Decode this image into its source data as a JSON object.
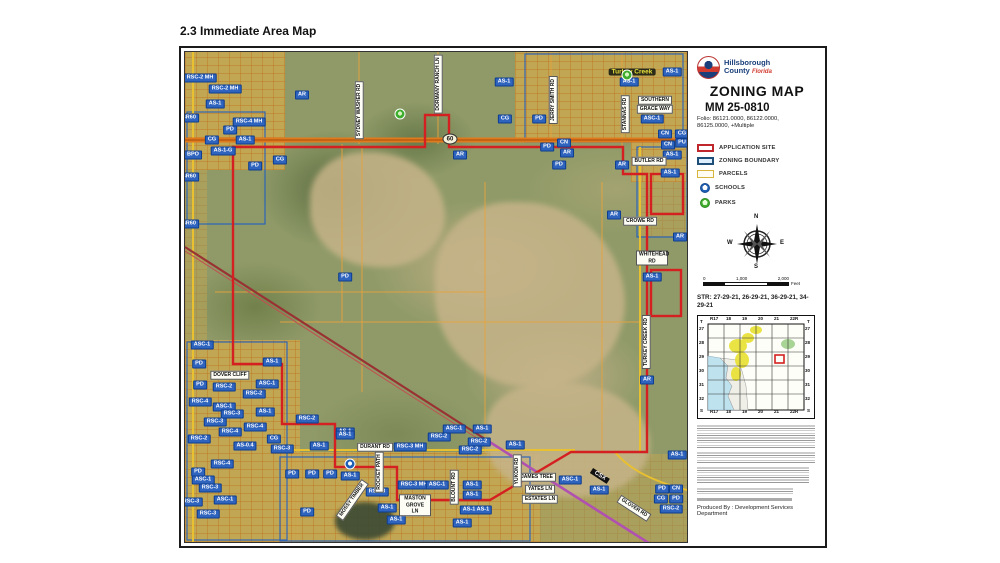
{
  "page": {
    "title": "2.3 Immediate Area Map"
  },
  "sidebar": {
    "logo": {
      "org_line1": "Hillsborough",
      "org_line2": "County",
      "state": "Florida"
    },
    "map_title": "ZONING MAP",
    "case_number": "MM 25-0810",
    "folio": "Folio: 86121.0000, 86122.0000, 86125.0000, +Multiple",
    "legend": {
      "items": [
        {
          "label": "APPLICATION SITE",
          "swatch": "app",
          "color": "#c0272d"
        },
        {
          "label": "ZONING BOUNDARY",
          "swatch": "zb",
          "color": "#1f4e79"
        },
        {
          "label": "PARCELS",
          "swatch": "par",
          "color": "#d8b53c"
        },
        {
          "label": "SCHOOLS",
          "swatch": "sch",
          "color": "#1f5fb5"
        },
        {
          "label": "PARKS",
          "swatch": "prk",
          "color": "#3fae2f"
        }
      ]
    },
    "compass": {
      "n": "N",
      "e": "E",
      "s": "S",
      "w": "W"
    },
    "scale": {
      "ticks": [
        "0",
        "1,000",
        "2,000"
      ],
      "unit": "Feet"
    },
    "str": "STR: 27-29-21, 26-29-21, 36-29-21, 34-29-21",
    "locator": {
      "cols": [
        "R17",
        "18",
        "19",
        "20",
        "21",
        "22R"
      ],
      "rows": [
        "27",
        "28",
        "29",
        "30",
        "31",
        "32"
      ],
      "corner_top": "T",
      "corner_bottom": "S",
      "highlight_cell": {
        "col": "21",
        "row": "29"
      }
    },
    "produced_by": "Produced By : Development Services Department"
  },
  "map": {
    "shield_60": "60",
    "labels": [
      {
        "x": 15,
        "y": 26,
        "t": "RSC-2 MH",
        "k": "z"
      },
      {
        "x": 40,
        "y": 37,
        "t": "RSC-2 MH",
        "k": "z"
      },
      {
        "x": 30,
        "y": 52,
        "t": "AS-1",
        "k": "z"
      },
      {
        "x": 64,
        "y": 70,
        "t": "RSC-4 MH",
        "k": "z"
      },
      {
        "x": 45,
        "y": 78,
        "t": "PD",
        "k": "z"
      },
      {
        "x": 27,
        "y": 88,
        "t": "CG",
        "k": "z"
      },
      {
        "x": 60,
        "y": 88,
        "t": "AS-1",
        "k": "z"
      },
      {
        "x": 38,
        "y": 99,
        "t": "AS-1-G",
        "k": "z"
      },
      {
        "x": 8,
        "y": 103,
        "t": "BPO",
        "k": "z"
      },
      {
        "x": 70,
        "y": 114,
        "t": "PD",
        "k": "z"
      },
      {
        "x": 95,
        "y": 108,
        "t": "CG",
        "k": "z"
      },
      {
        "x": 117,
        "y": 43,
        "t": "AR",
        "k": "z"
      },
      {
        "x": 4,
        "y": 66,
        "t": "SR60",
        "k": "z"
      },
      {
        "x": 4,
        "y": 125,
        "t": "SR60",
        "k": "z"
      },
      {
        "x": 4,
        "y": 172,
        "t": "SR60",
        "k": "z"
      },
      {
        "x": 319,
        "y": 30,
        "t": "AS-1",
        "k": "z"
      },
      {
        "x": 320,
        "y": 67,
        "t": "CG",
        "k": "z"
      },
      {
        "x": 354,
        "y": 67,
        "t": "PD",
        "k": "z"
      },
      {
        "x": 487,
        "y": 20,
        "t": "AS-1",
        "k": "z"
      },
      {
        "x": 444,
        "y": 30,
        "t": "AS-1",
        "k": "z"
      },
      {
        "x": 467,
        "y": 67,
        "t": "ASC-1",
        "k": "z"
      },
      {
        "x": 480,
        "y": 82,
        "t": "CN",
        "k": "z"
      },
      {
        "x": 497,
        "y": 82,
        "t": "CG",
        "k": "z"
      },
      {
        "x": 483,
        "y": 93,
        "t": "CN",
        "k": "z"
      },
      {
        "x": 497,
        "y": 91,
        "t": "PU",
        "k": "z"
      },
      {
        "x": 487,
        "y": 103,
        "t": "AS-1",
        "k": "z"
      },
      {
        "x": 437,
        "y": 113,
        "t": "AR",
        "k": "z"
      },
      {
        "x": 485,
        "y": 121,
        "t": "AS-1",
        "k": "z"
      },
      {
        "x": 362,
        "y": 95,
        "t": "PD",
        "k": "z"
      },
      {
        "x": 379,
        "y": 91,
        "t": "CN",
        "k": "z"
      },
      {
        "x": 382,
        "y": 101,
        "t": "AR",
        "k": "z"
      },
      {
        "x": 374,
        "y": 113,
        "t": "PD",
        "k": "z"
      },
      {
        "x": 275,
        "y": 103,
        "t": "AR",
        "k": "z"
      },
      {
        "x": 429,
        "y": 163,
        "t": "AR",
        "k": "z"
      },
      {
        "x": 495,
        "y": 185,
        "t": "AR",
        "k": "z"
      },
      {
        "x": 467,
        "y": 225,
        "t": "AS-1",
        "k": "z"
      },
      {
        "x": 462,
        "y": 328,
        "t": "AR",
        "k": "z"
      },
      {
        "x": 160,
        "y": 225,
        "t": "PD",
        "k": "z"
      },
      {
        "x": 17,
        "y": 293,
        "t": "ASC-1",
        "k": "z"
      },
      {
        "x": 14,
        "y": 312,
        "t": "PD",
        "k": "z"
      },
      {
        "x": 15,
        "y": 333,
        "t": "PD",
        "k": "z"
      },
      {
        "x": 39,
        "y": 335,
        "t": "RSC-2",
        "k": "z"
      },
      {
        "x": 87,
        "y": 310,
        "t": "AS-1",
        "k": "z"
      },
      {
        "x": 82,
        "y": 332,
        "t": "ASC-1",
        "k": "z"
      },
      {
        "x": 69,
        "y": 342,
        "t": "RSC-2",
        "k": "z"
      },
      {
        "x": 15,
        "y": 350,
        "t": "RSC-4",
        "k": "z"
      },
      {
        "x": 39,
        "y": 355,
        "t": "ASC-1",
        "k": "z"
      },
      {
        "x": 47,
        "y": 362,
        "t": "RSC-3",
        "k": "z"
      },
      {
        "x": 80,
        "y": 360,
        "t": "AS-1",
        "k": "z"
      },
      {
        "x": 30,
        "y": 370,
        "t": "RSC-3",
        "k": "z"
      },
      {
        "x": 70,
        "y": 375,
        "t": "RSC-4",
        "k": "z"
      },
      {
        "x": 45,
        "y": 380,
        "t": "RSC-4",
        "k": "z"
      },
      {
        "x": 14,
        "y": 387,
        "t": "RSC-2",
        "k": "z"
      },
      {
        "x": 89,
        "y": 387,
        "t": "CG",
        "k": "z"
      },
      {
        "x": 60,
        "y": 394,
        "t": "AS-0.4",
        "k": "z"
      },
      {
        "x": 97,
        "y": 397,
        "t": "RSC-3",
        "k": "z"
      },
      {
        "x": 122,
        "y": 367,
        "t": "RSC-2",
        "k": "z"
      },
      {
        "x": 160,
        "y": 380,
        "t": "AS-1",
        "k": "z"
      },
      {
        "x": 134,
        "y": 394,
        "t": "AS-1",
        "k": "z"
      },
      {
        "x": 225,
        "y": 395,
        "t": "RSC-3 MH",
        "k": "z"
      },
      {
        "x": 160,
        "y": 383,
        "t": "AS-1",
        "k": "z"
      },
      {
        "x": 269,
        "y": 377,
        "t": "ASC-1",
        "k": "z"
      },
      {
        "x": 297,
        "y": 377,
        "t": "AS-1",
        "k": "z"
      },
      {
        "x": 254,
        "y": 385,
        "t": "RSC-2",
        "k": "z"
      },
      {
        "x": 294,
        "y": 390,
        "t": "RSC-2",
        "k": "z"
      },
      {
        "x": 285,
        "y": 398,
        "t": "RSC-2",
        "k": "z"
      },
      {
        "x": 330,
        "y": 393,
        "t": "AS-1",
        "k": "z"
      },
      {
        "x": 165,
        "y": 424,
        "t": "AS-1",
        "k": "z"
      },
      {
        "x": 229,
        "y": 433,
        "t": "RSC-3 MH",
        "k": "z"
      },
      {
        "x": 252,
        "y": 433,
        "t": "ASC-1",
        "k": "z"
      },
      {
        "x": 287,
        "y": 433,
        "t": "AS-1",
        "k": "z"
      },
      {
        "x": 287,
        "y": 443,
        "t": "AS-1",
        "k": "z"
      },
      {
        "x": 192,
        "y": 440,
        "t": "RSC-3",
        "k": "z"
      },
      {
        "x": 202,
        "y": 456,
        "t": "AS-1",
        "k": "z"
      },
      {
        "x": 211,
        "y": 468,
        "t": "AS-1",
        "k": "z"
      },
      {
        "x": 291,
        "y": 458,
        "t": "AS-1 AS-1",
        "k": "z"
      },
      {
        "x": 277,
        "y": 471,
        "t": "AS-1",
        "k": "z"
      },
      {
        "x": 414,
        "y": 438,
        "t": "AS-1",
        "k": "z"
      },
      {
        "x": 477,
        "y": 437,
        "t": "PD",
        "k": "z"
      },
      {
        "x": 476,
        "y": 447,
        "t": "CG",
        "k": "z"
      },
      {
        "x": 491,
        "y": 437,
        "t": "CN",
        "k": "z"
      },
      {
        "x": 491,
        "y": 447,
        "t": "PD",
        "k": "z"
      },
      {
        "x": 486,
        "y": 457,
        "t": "RSC-2",
        "k": "z"
      },
      {
        "x": 492,
        "y": 403,
        "t": "AS-1",
        "k": "z"
      },
      {
        "x": 385,
        "y": 428,
        "t": "ASC-1",
        "k": "z"
      },
      {
        "x": 37,
        "y": 412,
        "t": "RSC-4",
        "k": "z"
      },
      {
        "x": 13,
        "y": 420,
        "t": "PD",
        "k": "z"
      },
      {
        "x": 18,
        "y": 428,
        "t": "ASC-1",
        "k": "z"
      },
      {
        "x": 25,
        "y": 436,
        "t": "RSC-3",
        "k": "z"
      },
      {
        "x": 6,
        "y": 450,
        "t": "RSC-3",
        "k": "z"
      },
      {
        "x": 40,
        "y": 448,
        "t": "ASC-1",
        "k": "z"
      },
      {
        "x": 23,
        "y": 462,
        "t": "RSC-3",
        "k": "z"
      },
      {
        "x": 107,
        "y": 422,
        "t": "PD",
        "k": "z"
      },
      {
        "x": 127,
        "y": 422,
        "t": "PD",
        "k": "z"
      },
      {
        "x": 145,
        "y": 422,
        "t": "PD",
        "k": "z"
      },
      {
        "x": 122,
        "y": 460,
        "t": "PD",
        "k": "z"
      },
      {
        "x": 470,
        "y": 48,
        "t": "SOUTHERN",
        "k": "r"
      },
      {
        "x": 470,
        "y": 57,
        "t": "GRACE WAY",
        "k": "r"
      },
      {
        "x": 464,
        "y": 109,
        "t": "BUTLER RD",
        "k": "r"
      },
      {
        "x": 455,
        "y": 169,
        "t": "CROWE RD",
        "k": "r"
      },
      {
        "x": 467,
        "y": 206,
        "t": "WHITEHEAD RD",
        "k": "r",
        "wrap": true
      },
      {
        "x": 45,
        "y": 323,
        "t": "DOVER CLIFF",
        "k": "r"
      },
      {
        "x": 190,
        "y": 395,
        "t": "DURANT RD",
        "k": "r"
      },
      {
        "x": 230,
        "y": 453,
        "t": "MASTON GROVE LN",
        "k": "r",
        "wrap": true
      },
      {
        "x": 352,
        "y": 425,
        "t": "JAMES TREE",
        "k": "r"
      },
      {
        "x": 355,
        "y": 437,
        "t": "YATES LN",
        "k": "r"
      },
      {
        "x": 355,
        "y": 447,
        "t": "ESTATES LN",
        "k": "r"
      },
      {
        "x": 174,
        "y": 58,
        "t": "SYDNEY WASHER RD",
        "k": "rv"
      },
      {
        "x": 253,
        "y": 32,
        "t": "DORMANY RANCH LN",
        "k": "rv"
      },
      {
        "x": 368,
        "y": 48,
        "t": "JERRY SMITH RD",
        "k": "rv"
      },
      {
        "x": 440,
        "y": 62,
        "t": "STANNAS RD",
        "k": "rv"
      },
      {
        "x": 461,
        "y": 290,
        "t": "TURKEY CREEK RD",
        "k": "rv"
      },
      {
        "x": 194,
        "y": 420,
        "t": "ROCKET PATH",
        "k": "rv"
      },
      {
        "x": 269,
        "y": 435,
        "t": "BLOUNT RD",
        "k": "rv"
      },
      {
        "x": 332,
        "y": 419,
        "t": "YUKON RD",
        "k": "rv"
      },
      {
        "x": 449,
        "y": 456,
        "t": "GLOVER RD",
        "k": "r",
        "r": 33
      },
      {
        "x": 167,
        "y": 448,
        "t": "MOSSY TIMBER",
        "k": "r",
        "r": -55
      },
      {
        "x": 447,
        "y": 20,
        "t": "Turkey Creek",
        "k": "pl"
      },
      {
        "x": 415,
        "y": 424,
        "t": "CSX",
        "k": "csx"
      },
      {
        "x": 265,
        "y": 87,
        "t": "60",
        "k": "sh"
      }
    ],
    "icons": [
      {
        "k": "school",
        "x": 165,
        "y": 412
      },
      {
        "k": "park",
        "x": 215,
        "y": 62
      },
      {
        "k": "park",
        "x": 442,
        "y": 23
      }
    ]
  }
}
